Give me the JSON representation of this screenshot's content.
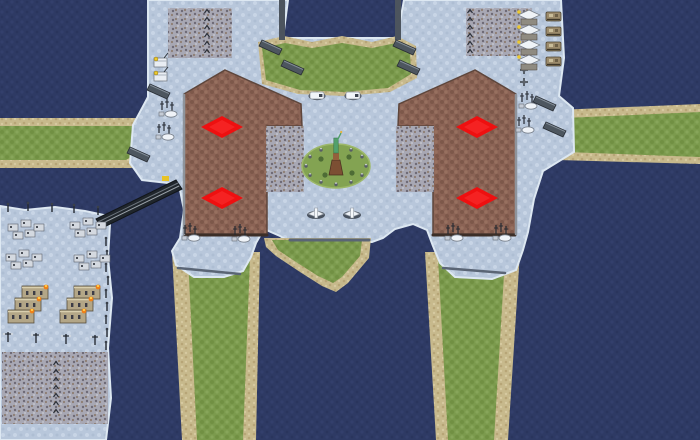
{
  "map": {
    "description": "snow-theme RTS map overview with four player spawn markers",
    "canvas": {
      "width": 700,
      "height": 440
    },
    "palette": {
      "water": "#2e3a64",
      "snow": "#b8c7db",
      "grass": "#7b9a4d",
      "dirt": "#8b6355",
      "sand": "#c7b98c",
      "rough": "#a8a8b4",
      "spawn_red": "#ee1010",
      "cliff_dark": "#3c2e27",
      "cliff_light": "#8e949c",
      "bridge": "#20262c",
      "mound_green": "#83a352"
    },
    "spawn_points": [
      {
        "x": 222,
        "y": 127
      },
      {
        "x": 222,
        "y": 198
      },
      {
        "x": 477,
        "y": 127
      },
      {
        "x": 477,
        "y": 198
      }
    ],
    "features": [
      {
        "n": "ocean",
        "k": "rect",
        "f": "water",
        "x": 0,
        "y": 0,
        "wd": 700,
        "ht": 440
      },
      {
        "n": "west-causeway-sand",
        "k": "poly",
        "f": "sand",
        "p": "0,118 138,118 152,131 152,154 134,168 0,168"
      },
      {
        "n": "west-causeway-grass",
        "k": "poly",
        "f": "grass",
        "p": "0,126 132,126 143,139 141,151 126,160 0,160"
      },
      {
        "n": "east-causeway-sand",
        "k": "poly",
        "f": "sand",
        "p": "556,110 700,104 700,164 558,160 546,134"
      },
      {
        "n": "east-causeway-grass",
        "k": "poly",
        "f": "grass",
        "p": "564,118 700,112 700,157 566,152 557,134"
      },
      {
        "n": "south-left-causeway-sand",
        "k": "poly",
        "f": "sand",
        "p": "172,252 260,252 256,440 182,440"
      },
      {
        "n": "south-left-causeway-grass",
        "k": "poly",
        "f": "grass",
        "p": "188,258 250,258 243,440 197,440"
      },
      {
        "n": "south-right-causeway-sand",
        "k": "poly",
        "f": "sand",
        "p": "425,252 520,252 508,440 436,440"
      },
      {
        "n": "south-right-causeway-grass",
        "k": "poly",
        "f": "grass",
        "p": "438,258 505,258 494,440 448,440"
      },
      {
        "n": "main-snow-landmass",
        "k": "poly",
        "f": "snow",
        "s": "#dde8f2",
        "w": 2,
        "p": "148,0 288,0 283,38 397,38 404,0 561,0 564,58 559,96 573,108 574,152 543,171 534,199 528,232 523,250 516,270 492,279 455,277 440,263 433,246 427,230 413,224 395,229 383,238 372,242 290,242 280,236 264,229 256,243 251,257 243,271 224,277 194,277 176,265 172,251 180,238 184,210 180,190 168,183 142,180 130,163 133,125 148,97"
      },
      {
        "n": "heart-island-sand",
        "k": "poly",
        "f": "sand",
        "p": "264,238 371,238 369,258 348,283 336,292 322,286 300,272 276,256 266,247"
      },
      {
        "n": "heart-island-grass",
        "k": "poly",
        "f": "grass",
        "p": "272,240 362,240 360,256 342,277 333,283 318,276 296,262 278,250"
      },
      {
        "n": "top-field-sand",
        "k": "poly",
        "f": "sand",
        "p": "258,42 284,36 312,42 342,36 372,42 397,36 416,46 417,78 390,92 344,96 298,94 262,84"
      },
      {
        "n": "top-field-grass",
        "k": "poly",
        "f": "grass",
        "p": "262,48 285,43 312,48 342,43 372,48 396,43 410,52 411,74 388,88 344,92 300,90 266,80"
      },
      {
        "n": "inlet-west-wall",
        "k": "rect",
        "f": "#4c545e",
        "x": 279,
        "y": 0,
        "wd": 6,
        "ht": 40
      },
      {
        "n": "inlet-east-wall",
        "k": "rect",
        "f": "#4c545e",
        "x": 395,
        "y": 0,
        "wd": 6,
        "ht": 40
      },
      {
        "n": "left-plateau",
        "k": "poly",
        "f": "dirt",
        "s": "#5e463c",
        "w": 1.5,
        "p": "225,70 301,104 302,126 267,126 267,234 184,234 184,94"
      },
      {
        "n": "right-plateau",
        "k": "poly",
        "f": "dirt",
        "s": "#5e463c",
        "w": 1.5,
        "p": "475,70 399,104 398,126 433,126 433,234 516,234 516,94"
      },
      {
        "n": "left-plateau-rough-patch",
        "k": "rect",
        "f": "rough",
        "x": 266,
        "y": 126,
        "wd": 38,
        "ht": 66
      },
      {
        "n": "right-plateau-rough-patch",
        "k": "rect",
        "f": "rough",
        "x": 396,
        "y": 126,
        "wd": 38,
        "ht": 66
      },
      {
        "n": "top-left-rough-patch",
        "k": "rect",
        "f": "rough",
        "x": 168,
        "y": 8,
        "wd": 64,
        "ht": 50
      },
      {
        "n": "top-right-rough-patch",
        "k": "rect",
        "f": "rough",
        "x": 466,
        "y": 8,
        "wd": 66,
        "ht": 48
      },
      {
        "n": "left-plateau-south-cliff",
        "k": "line",
        "s": "#3c2e27",
        "w": 3,
        "x1": 185,
        "y1": 235,
        "x2": 267,
        "y2": 235
      },
      {
        "n": "right-plateau-south-cliff",
        "k": "line",
        "s": "#3c2e27",
        "w": 3,
        "x1": 433,
        "y1": 235,
        "x2": 515,
        "y2": 235
      },
      {
        "n": "left-plateau-west-cliff",
        "k": "line",
        "s": "#8e949c",
        "w": 2.5,
        "x1": 184,
        "y1": 95,
        "x2": 184,
        "y2": 234
      },
      {
        "n": "right-plateau-east-cliff",
        "k": "line",
        "s": "#8e949c",
        "w": 2.5,
        "x1": 516,
        "y1": 95,
        "x2": 516,
        "y2": 234
      },
      {
        "n": "central-ledge-cliff",
        "k": "line",
        "s": "#5a6575",
        "w": 3,
        "x1": 290,
        "y1": 240,
        "x2": 369,
        "y2": 240
      },
      {
        "n": "left-ledge-cliff",
        "k": "line",
        "s": "#5a6575",
        "w": 2.5,
        "x1": 178,
        "y1": 268,
        "x2": 240,
        "y2": 274
      },
      {
        "n": "right-ledge-cliff",
        "k": "line",
        "s": "#5a6575",
        "w": 2.5,
        "x1": 443,
        "y1": 268,
        "x2": 505,
        "y2": 273
      },
      {
        "n": "statue-mound",
        "k": "ellipse",
        "f": "mound",
        "s": "#9db86a",
        "w": 1.5,
        "cx": 336,
        "cy": 166,
        "rx": 34,
        "ry": 22
      },
      {
        "n": "bottom-left-island",
        "k": "poly",
        "f": "snow",
        "s": "#dde8f2",
        "w": 2,
        "p": "0,206 25,210 55,207 85,211 104,215 110,224 108,258 112,298 108,348 111,398 106,440 0,440"
      },
      {
        "n": "island-rough-patch",
        "k": "rect",
        "f": "rough",
        "x": 2,
        "y": 352,
        "wd": 106,
        "ht": 72
      },
      {
        "n": "bridge-deck",
        "k": "poly",
        "f": "#20262c",
        "s": "#11151a",
        "w": 1,
        "p": "96,219 176,180 182,189 102,228"
      },
      {
        "n": "bridge-lane-line",
        "k": "line",
        "s": "#98a0a8",
        "w": 1,
        "x1": 99,
        "y1": 225,
        "x2": 179,
        "y2": 186
      },
      {
        "n": "bridge-lane-line-2",
        "k": "line",
        "s": "#6d757e",
        "w": 1,
        "x1": 98,
        "y1": 222,
        "x2": 178,
        "y2": 183
      },
      {
        "n": "bridge-car",
        "k": "rect",
        "f": "#e8c327",
        "x": 162,
        "y": 176,
        "wd": 7,
        "ht": 5
      },
      {
        "n": "shore-pole",
        "k": "pole",
        "at": [
          [
            8,
            212
          ],
          [
            28,
            211
          ],
          [
            52,
            212
          ],
          [
            74,
            213
          ],
          [
            98,
            215
          ]
        ]
      },
      {
        "n": "boundary-pole-column",
        "k": "pole",
        "at": [
          [
            106,
            246
          ],
          [
            107,
            259
          ],
          [
            106,
            272
          ],
          [
            108,
            285
          ],
          [
            106,
            298
          ],
          [
            107,
            311
          ],
          [
            106,
            324
          ],
          [
            107,
            337
          ],
          [
            106,
            350
          ]
        ]
      },
      {
        "n": "flag-marker-column-left",
        "k": "mark",
        "at": [
          [
            207,
            12
          ],
          [
            207,
            20
          ],
          [
            207,
            28
          ],
          [
            207,
            36
          ],
          [
            207,
            44
          ],
          [
            207,
            52
          ]
        ]
      },
      {
        "n": "flag-marker-column-right",
        "k": "mark",
        "at": [
          [
            470,
            12
          ],
          [
            470,
            20
          ],
          [
            470,
            28
          ],
          [
            470,
            36
          ],
          [
            470,
            44
          ],
          [
            470,
            52
          ]
        ]
      },
      {
        "n": "rough-ground-marks",
        "k": "mark",
        "at": [
          [
            56,
            364
          ],
          [
            56,
            372
          ],
          [
            56,
            380
          ],
          [
            56,
            388
          ],
          [
            56,
            396
          ],
          [
            56,
            404
          ],
          [
            56,
            412
          ]
        ]
      },
      {
        "n": "ruined-village-cluster",
        "k": "ruin",
        "at": [
          [
            8,
            220
          ],
          [
            70,
            218
          ],
          [
            6,
            250
          ],
          [
            74,
            251
          ]
        ]
      },
      {
        "n": "fortress-building",
        "k": "castle",
        "at": [
          [
            8,
            286
          ],
          [
            60,
            286
          ]
        ]
      },
      {
        "n": "street-lamp",
        "k": "lamp",
        "at": [
          [
            8,
            342
          ],
          [
            36,
            343
          ],
          [
            66,
            344
          ],
          [
            95,
            345
          ]
        ]
      },
      {
        "n": "tech-derrick",
        "k": "derrick",
        "at": [
          [
            154,
            58
          ],
          [
            154,
            72
          ]
        ]
      },
      {
        "n": "radar-outpost",
        "k": "radar",
        "at": [
          [
            162,
            110
          ],
          [
            159,
            133
          ],
          [
            522,
            102
          ],
          [
            519,
            126
          ],
          [
            185,
            234
          ],
          [
            235,
            235
          ],
          [
            448,
            234
          ],
          [
            496,
            234
          ]
        ]
      },
      {
        "n": "aa-gun",
        "k": "aa",
        "at": [
          [
            524,
            70
          ],
          [
            524,
            82
          ]
        ]
      },
      {
        "n": "tech-building",
        "k": "techbldg",
        "at": [
          [
            518,
            10
          ],
          [
            518,
            25
          ],
          [
            518,
            40
          ],
          [
            518,
            55
          ]
        ]
      },
      {
        "n": "wrecked-vehicle",
        "k": "wreck",
        "at": [
          [
            546,
            12
          ],
          [
            546,
            27
          ],
          [
            546,
            42
          ],
          [
            546,
            57
          ]
        ]
      },
      {
        "n": "white-vehicle",
        "k": "unit",
        "at": [
          [
            310,
            92
          ],
          [
            346,
            92
          ]
        ]
      },
      {
        "n": "aircraft",
        "k": "plane",
        "at": [
          [
            308,
            210
          ],
          [
            344,
            210
          ]
        ]
      },
      {
        "n": "cliff-gate-slab",
        "k": "slab",
        "at": [
          [
            262,
            40
          ],
          [
            396,
            40
          ],
          [
            284,
            60
          ],
          [
            400,
            60
          ],
          [
            536,
            96
          ],
          [
            546,
            122
          ],
          [
            150,
            84
          ],
          [
            130,
            147
          ]
        ]
      },
      {
        "n": "monument-statue-of-liberty",
        "k": "monument",
        "at": [
          [
            336,
            166
          ]
        ]
      },
      {
        "n": "spawn-marker",
        "k": "spawn",
        "i": true,
        "at": [
          [
            222,
            127
          ],
          [
            222,
            198
          ],
          [
            477,
            127
          ],
          [
            477,
            198
          ]
        ]
      }
    ]
  }
}
